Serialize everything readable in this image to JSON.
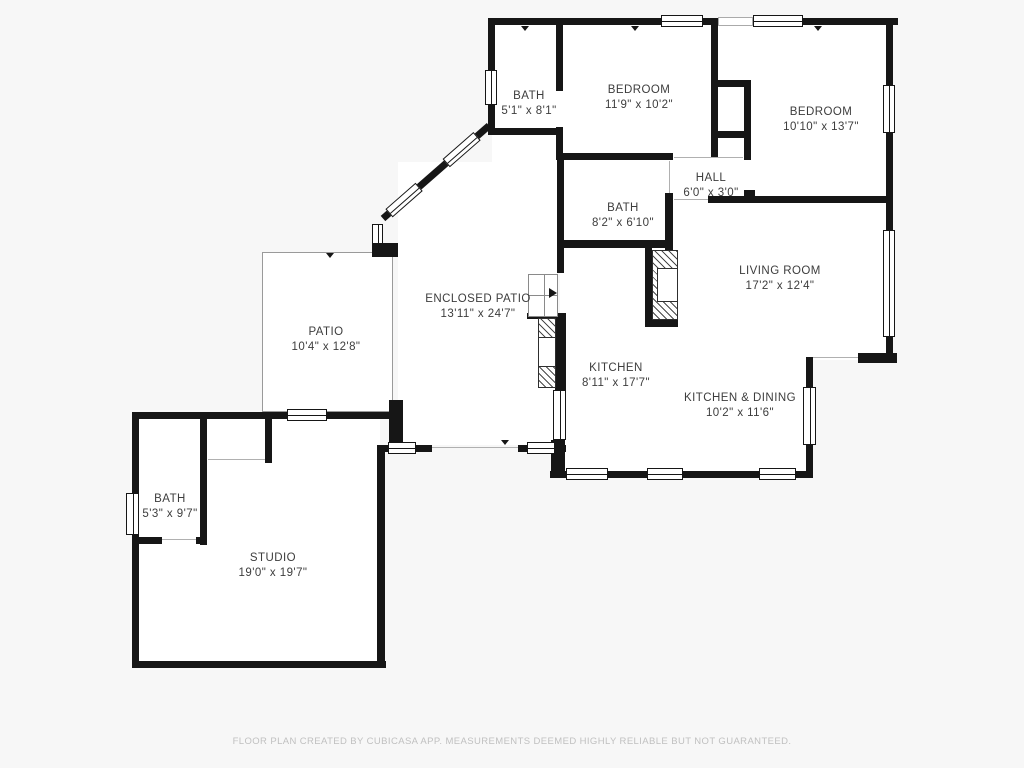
{
  "floor_plan": {
    "rooms": {
      "bath1": {
        "name": "BATH",
        "dims": "5'1\" x 8'1\""
      },
      "bedroom1": {
        "name": "BEDROOM",
        "dims": "11'9\" x 10'2\""
      },
      "bedroom2": {
        "name": "BEDROOM",
        "dims": "10'10\" x 13'7\""
      },
      "hall": {
        "name": "HALL",
        "dims": "6'0\" x 3'0\""
      },
      "bath2": {
        "name": "BATH",
        "dims": "8'2\" x 6'10\""
      },
      "living_room": {
        "name": "LIVING ROOM",
        "dims": "17'2\" x 12'4\""
      },
      "enclosed_patio": {
        "name": "ENCLOSED PATIO",
        "dims": "13'11\" x 24'7\""
      },
      "patio": {
        "name": "PATIO",
        "dims": "10'4\" x 12'8\""
      },
      "kitchen": {
        "name": "KITCHEN",
        "dims": "8'11\" x 17'7\""
      },
      "kitchen_dining": {
        "name": "KITCHEN & DINING",
        "dims": "10'2\" x 11'6\""
      },
      "bath3": {
        "name": "BATH",
        "dims": "5'3\" x 9'7\""
      },
      "studio": {
        "name": "STUDIO",
        "dims": "19'0\" x 19'7\""
      }
    },
    "footer": {
      "text": "FLOOR PLAN CREATED BY CUBICASA APP. MEASUREMENTS DEEMED HIGHLY RELIABLE BUT NOT GUARANTEED."
    },
    "colors": {
      "wall": "#161616",
      "background": "#f7f7f7",
      "room_fill": "#ffffff",
      "label_text": "#3d3d3d",
      "footer_text": "#c0c0c0"
    }
  }
}
